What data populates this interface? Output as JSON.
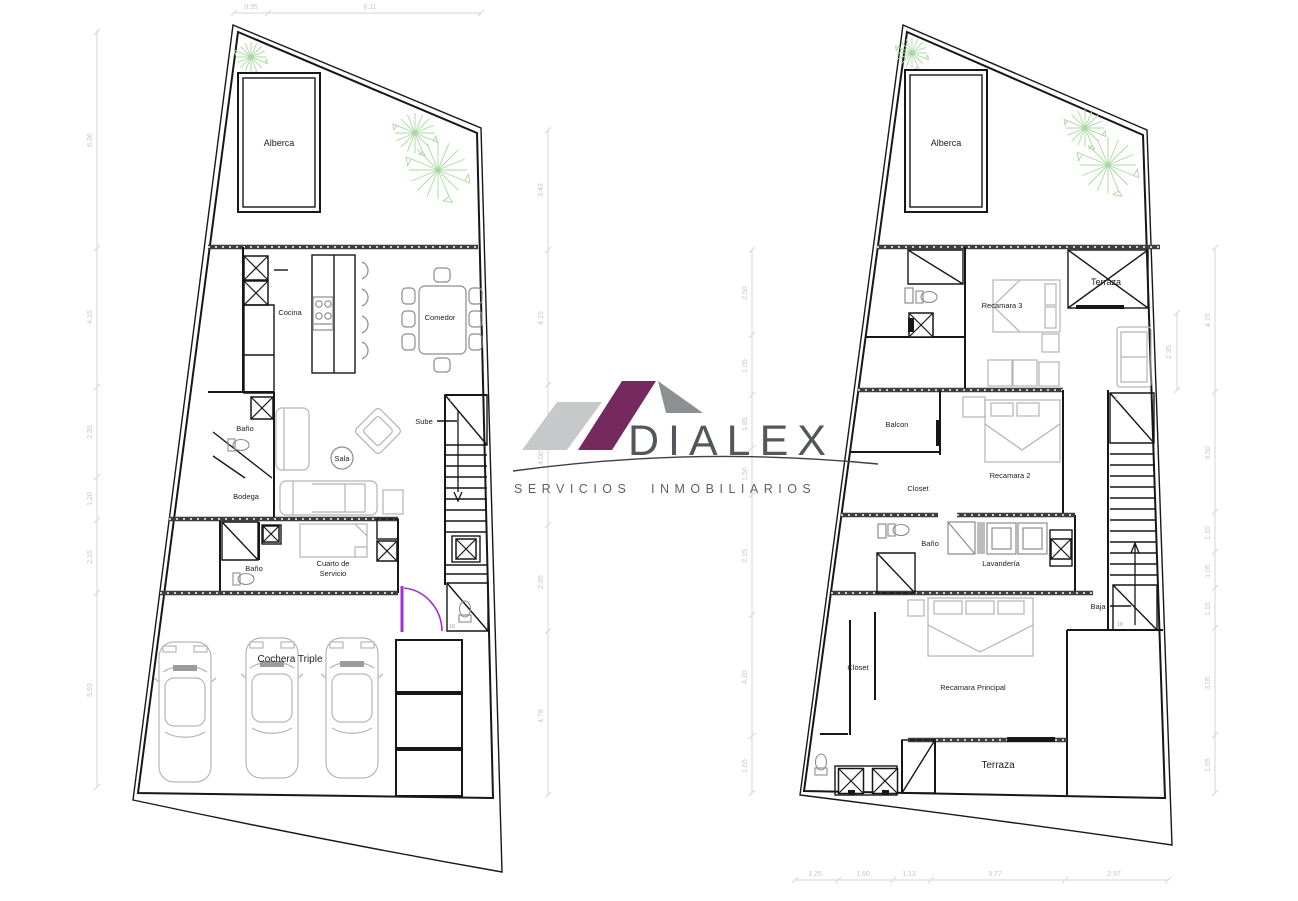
{
  "logo": {
    "name": "DIALEX",
    "tagline_word1": "SERVICIOS",
    "tagline_word2": "INMOBILIARIOS",
    "colors": {
      "purple": "#76295f",
      "roof_gray": "#8d9093",
      "light_gray": "#c7c8ca",
      "text": "#54575a"
    }
  },
  "palette": {
    "walls": "#171717",
    "furniture": "#b3b3b3",
    "dimension_lines": "#d6d6d6",
    "tree_green": "#abd8a2",
    "door_accent": "#a22fd2"
  },
  "floor_plans": [
    {
      "name": "ground-floor",
      "rooms": {
        "pool": "Alberca",
        "kitchen": "Cocina",
        "dining": "Comedor",
        "living": "Sala",
        "bath1": "Baño",
        "storage": "Bodega",
        "bath2": "Baño",
        "service_line1": "Cuarto de",
        "service_line2": "Servicio",
        "garage": "Cochera Triple",
        "stairs": "Sube"
      },
      "stair_first": "1",
      "stair_last": "18",
      "dims_top": [
        "0.95",
        "6.11"
      ],
      "dims_left": [
        "6.36",
        "4.15",
        "2.35",
        "1.20",
        "2.15",
        "5.93"
      ],
      "dims_right": [
        "3.43",
        "4.15",
        "4.00",
        "2.85",
        "4.78"
      ]
    },
    {
      "name": "upper-floor",
      "rooms": {
        "pool": "Alberca",
        "bedroom3": "Recamara 3",
        "terrace_top": "Terraza",
        "balcony": "Balcon",
        "bedroom2": "Recamara 2",
        "closet1": "Closet",
        "bath": "Baño",
        "laundry": "Lavandería",
        "stairs": "Baja",
        "closet2": "Closet",
        "master": "Recamara Principal",
        "terrace_bottom": "Terraza"
      },
      "stair_first": "1",
      "stair_last": "18",
      "dims_left": [
        "2.50",
        "1.05",
        "1.85",
        "1.50",
        "2.15",
        "4.20",
        "1.65"
      ],
      "dims_right": [
        "4.15",
        "3.50",
        "1.10",
        "1.05",
        "1.15",
        "3.05",
        "1.65"
      ],
      "dims_inner": [
        "2.35"
      ],
      "dims_bottom": [
        "1.25",
        "1.60",
        "1.13",
        "3.77",
        "2.97"
      ]
    }
  ]
}
